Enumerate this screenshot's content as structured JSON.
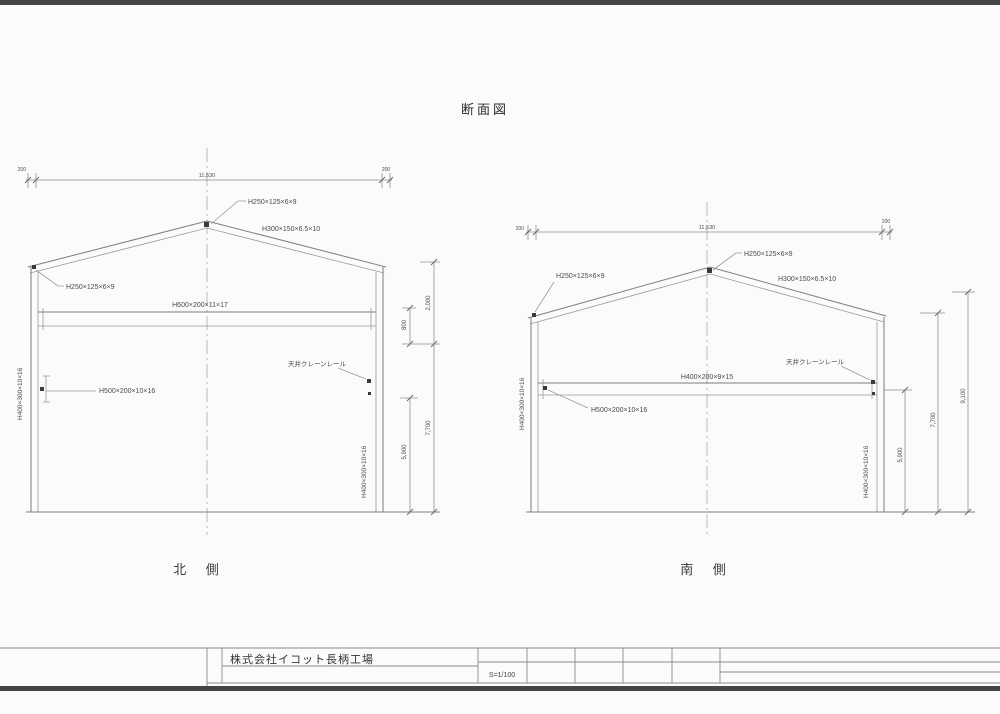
{
  "page": {
    "title": "断面図",
    "company": "株式会社イコット長柄工場",
    "scale": "S=1/100"
  },
  "north": {
    "caption": "北 側",
    "dim_end_left": "200",
    "dim_span": "11,530",
    "dim_end_right": "200",
    "dim_upper": "2,000",
    "dim_beam": "800",
    "dim_eave": "7,700",
    "dim_crane": "5,900",
    "apex_member": "H250×125×6×9",
    "rafter_member": "H300×150×6.5×10",
    "eave_member": "H250×125×6×9",
    "tie_member": "H600×200×11×17",
    "bracket_member": "H500×200×10×16",
    "crane_rail": "天井クレーンレール",
    "column_left": "H400×300×10×16",
    "column_right": "H400×300×10×16"
  },
  "south": {
    "caption": "南 側",
    "dim_end_left": "200",
    "dim_span": "11,530",
    "dim_end_right": "200",
    "dim_crane": "5,900",
    "dim_eave": "7,700",
    "dim_total": "9,100",
    "apex_member": "H250×125×6×9",
    "rafter_member": "H300×150×6.5×10",
    "eave_member": "H250×125×6×9",
    "tie_member": "H400×200×9×15",
    "bracket_member": "H500×200×10×16",
    "crane_rail": "天井クレーンレール",
    "column_left": "H400×300×10×16",
    "column_right": "H400×300×10×16"
  }
}
